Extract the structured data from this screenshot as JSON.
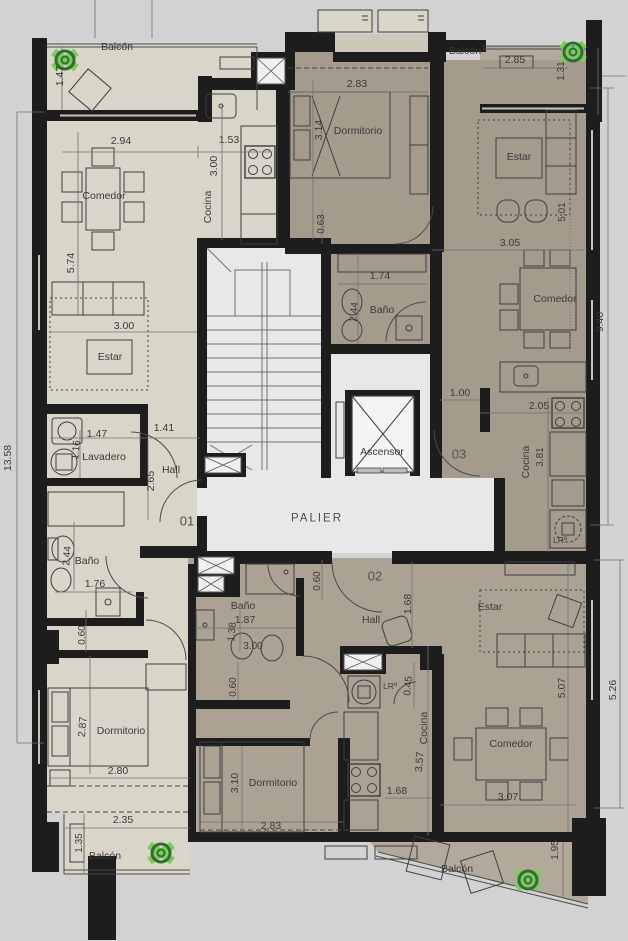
{
  "plan": {
    "type": "architectural-floor-plan",
    "units": [
      "01",
      "02",
      "03"
    ],
    "colors": {
      "background": "#d2d2d2",
      "wall": "#1d1d1d",
      "unit01_floor": "#d9d5c8",
      "unit03_floor": "#a49b8d",
      "unit02_floor": "#aba294",
      "balcony_floor": "#b2a99b",
      "core_floor": "#e8e8e8",
      "elevator_floor": "#f4f4f4",
      "plant_green": "#4ea83c",
      "text": "#3a3a3a"
    },
    "labels": [
      {
        "name": "balcon-01-top",
        "text": "Balcón",
        "x": 117,
        "y": 47,
        "rot": 0,
        "fs": 10.5
      },
      {
        "name": "dim-1-47-v",
        "text": "1.47",
        "x": 60,
        "y": 76,
        "rot": -90,
        "fs": 10.5
      },
      {
        "name": "dim-2-94",
        "text": "2.94",
        "x": 121,
        "y": 141,
        "rot": 0,
        "fs": 10.5
      },
      {
        "name": "dim-1-53",
        "text": "1.53",
        "x": 229,
        "y": 140,
        "rot": 0,
        "fs": 10.5
      },
      {
        "name": "dim-3-00-cocina",
        "text": "3.00",
        "x": 214,
        "y": 166,
        "rot": -90,
        "fs": 10.5
      },
      {
        "name": "cocina-01",
        "text": "Cocina",
        "x": 208,
        "y": 207,
        "rot": -90,
        "fs": 10.5
      },
      {
        "name": "comedor-01",
        "text": "Comedor",
        "x": 104,
        "y": 196,
        "rot": 0,
        "fs": 10.5
      },
      {
        "name": "dim-5-74",
        "text": "5.74",
        "x": 71,
        "y": 263,
        "rot": -90,
        "fs": 10.5
      },
      {
        "name": "dim-3-00-estar",
        "text": "3.00",
        "x": 124,
        "y": 326,
        "rot": 0,
        "fs": 10.5
      },
      {
        "name": "estar-01",
        "text": "Estar",
        "x": 110,
        "y": 357,
        "rot": 0,
        "fs": 10.5
      },
      {
        "name": "dim-13-58",
        "text": "13.58",
        "x": 8,
        "y": 458,
        "rot": -90,
        "fs": 10.5
      },
      {
        "name": "dim-1-47-lav",
        "text": "1.47",
        "x": 97,
        "y": 434,
        "rot": 0,
        "fs": 10.5
      },
      {
        "name": "dim-1-41",
        "text": "1.41",
        "x": 164,
        "y": 428,
        "rot": 0,
        "fs": 10.5
      },
      {
        "name": "lavadero-01",
        "text": "Lavadero",
        "x": 104,
        "y": 457,
        "rot": 0,
        "fs": 10.5
      },
      {
        "name": "dim-1-16",
        "text": "1.16",
        "x": 77,
        "y": 450,
        "rot": -85,
        "fs": 10
      },
      {
        "name": "hall-01",
        "text": "Hall",
        "x": 171,
        "y": 470,
        "rot": 0,
        "fs": 10.5
      },
      {
        "name": "dim-2-65",
        "text": "2.65",
        "x": 151,
        "y": 481,
        "rot": -90,
        "fs": 10.5
      },
      {
        "name": "unit-01",
        "text": "01",
        "x": 187,
        "y": 521,
        "rot": 0,
        "fs": 13,
        "color": "#55504a"
      },
      {
        "name": "bano-01",
        "text": "Baño",
        "x": 87,
        "y": 561,
        "rot": 0,
        "fs": 10.5
      },
      {
        "name": "dim-2-44-b1",
        "text": "2.44",
        "x": 68,
        "y": 556,
        "rot": -85,
        "fs": 10
      },
      {
        "name": "dim-1-76",
        "text": "1.76",
        "x": 95,
        "y": 584,
        "rot": 0,
        "fs": 10.5
      },
      {
        "name": "dim-0-60-b1",
        "text": "0.60",
        "x": 83,
        "y": 635,
        "rot": -90,
        "fs": 10
      },
      {
        "name": "dim-2-87",
        "text": "2.87",
        "x": 83,
        "y": 727,
        "rot": -85,
        "fs": 10.5
      },
      {
        "name": "dormitorio-01",
        "text": "Dormitorio",
        "x": 121,
        "y": 731,
        "rot": 0,
        "fs": 10.5
      },
      {
        "name": "dim-2-80",
        "text": "2.80",
        "x": 118,
        "y": 771,
        "rot": 0,
        "fs": 10.5
      },
      {
        "name": "dim-2-35",
        "text": "2.35",
        "x": 123,
        "y": 820,
        "rot": 0,
        "fs": 10.5
      },
      {
        "name": "dim-1-35",
        "text": "1.35",
        "x": 80,
        "y": 843,
        "rot": -90,
        "fs": 10
      },
      {
        "name": "balcon-01-bottom",
        "text": "Balcón",
        "x": 105,
        "y": 856,
        "rot": 0,
        "fs": 10.5
      },
      {
        "name": "dim-2-83-d3",
        "text": "2.83",
        "x": 357,
        "y": 84,
        "rot": 0,
        "fs": 10.5
      },
      {
        "name": "dim-3-14",
        "text": "3.14",
        "x": 319,
        "y": 130,
        "rot": -90,
        "fs": 10.5
      },
      {
        "name": "dormitorio-03",
        "text": "Dormitorio",
        "x": 358,
        "y": 131,
        "rot": 0,
        "fs": 10.5
      },
      {
        "name": "balcon-03",
        "text": "Balcón",
        "x": 465,
        "y": 51,
        "rot": 0,
        "fs": 10.5
      },
      {
        "name": "dim-2-85",
        "text": "2.85",
        "x": 515,
        "y": 60,
        "rot": 0,
        "fs": 10.5
      },
      {
        "name": "dim-1-31",
        "text": "1.31",
        "x": 562,
        "y": 71,
        "rot": -90,
        "fs": 10
      },
      {
        "name": "estar-03",
        "text": "Estar",
        "x": 519,
        "y": 157,
        "rot": 0,
        "fs": 10.5
      },
      {
        "name": "dim-5-01",
        "text": "5.01",
        "x": 563,
        "y": 212,
        "rot": -90,
        "fs": 10
      },
      {
        "name": "dim-0-63",
        "text": "0.63",
        "x": 322,
        "y": 224,
        "rot": -90,
        "fs": 10
      },
      {
        "name": "dim-1-74",
        "text": "1.74",
        "x": 380,
        "y": 276,
        "rot": 0,
        "fs": 10.5
      },
      {
        "name": "bano-03",
        "text": "Baño",
        "x": 382,
        "y": 310,
        "rot": 0,
        "fs": 10.5
      },
      {
        "name": "dim-2-44-b3",
        "text": "2.44",
        "x": 355,
        "y": 312,
        "rot": -85,
        "fs": 10
      },
      {
        "name": "dim-3-05",
        "text": "3.05",
        "x": 510,
        "y": 243,
        "rot": 0,
        "fs": 10.5
      },
      {
        "name": "comedor-03",
        "text": "Comedor",
        "x": 555,
        "y": 299,
        "rot": 0,
        "fs": 10.5
      },
      {
        "name": "dim-9-40",
        "text": "9.40",
        "x": 600,
        "y": 322,
        "rot": -90,
        "fs": 10.5
      },
      {
        "name": "dim-1-00",
        "text": "1.00",
        "x": 460,
        "y": 393,
        "rot": 0,
        "fs": 10.5
      },
      {
        "name": "dim-2-05",
        "text": "2.05",
        "x": 539,
        "y": 406,
        "rot": 0,
        "fs": 10.5
      },
      {
        "name": "cocina-03",
        "text": "Cocina",
        "x": 526,
        "y": 462,
        "rot": -90,
        "fs": 10.5
      },
      {
        "name": "dim-3-81",
        "text": "3.81",
        "x": 541,
        "y": 457,
        "rot": -90,
        "fs": 10
      },
      {
        "name": "unit-03",
        "text": "03",
        "x": 459,
        "y": 454,
        "rot": 0,
        "fs": 13,
        "color": "#55504a"
      },
      {
        "name": "lavarropas-03",
        "text": "LRº",
        "x": 560,
        "y": 540,
        "rot": 0,
        "fs": 8.5
      },
      {
        "name": "ascensor",
        "text": "Ascensor",
        "x": 382,
        "y": 452,
        "rot": 0,
        "fs": 10.5
      },
      {
        "name": "palier",
        "text": "PALIER",
        "x": 317,
        "y": 519,
        "rot": 0,
        "fs": 11.5,
        "ls": 2,
        "color": "#4c4c4c"
      },
      {
        "name": "dim-0-60-top02",
        "text": "0.60",
        "x": 318,
        "y": 581,
        "rot": -90,
        "fs": 10
      },
      {
        "name": "unit-02",
        "text": "02",
        "x": 375,
        "y": 576,
        "rot": 0,
        "fs": 13,
        "color": "#55504a"
      },
      {
        "name": "bano-02",
        "text": "Baño",
        "x": 243,
        "y": 606,
        "rot": 0,
        "fs": 10.5
      },
      {
        "name": "dim-1-87",
        "text": "1.87",
        "x": 245,
        "y": 620,
        "rot": 0,
        "fs": 10.5
      },
      {
        "name": "hall-02",
        "text": "Hall",
        "x": 371,
        "y": 620,
        "rot": 0,
        "fs": 10.5
      },
      {
        "name": "dim-1-68-v",
        "text": "1.68",
        "x": 408,
        "y": 604,
        "rot": -90,
        "fs": 10.5
      },
      {
        "name": "dim-1-38",
        "text": "1.38",
        "x": 233,
        "y": 632,
        "rot": -85,
        "fs": 10
      },
      {
        "name": "dim-3-00-b2",
        "text": "3.00",
        "x": 253,
        "y": 647,
        "rot": 0,
        "fs": 10
      },
      {
        "name": "lavarropas-02",
        "text": "LRº",
        "x": 390,
        "y": 686,
        "rot": 0,
        "fs": 8.5
      },
      {
        "name": "dim-0-45",
        "text": "0.45",
        "x": 409,
        "y": 686,
        "rot": -85,
        "fs": 10
      },
      {
        "name": "dim-0-60-corr",
        "text": "0.60",
        "x": 234,
        "y": 687,
        "rot": -90,
        "fs": 10
      },
      {
        "name": "estar-02",
        "text": "Estar",
        "x": 490,
        "y": 607,
        "rot": 0,
        "fs": 10.5
      },
      {
        "name": "dim-5-07",
        "text": "5.07",
        "x": 562,
        "y": 688,
        "rot": -90,
        "fs": 10.5
      },
      {
        "name": "dim-5-26",
        "text": "5.26",
        "x": 613,
        "y": 690,
        "rot": -90,
        "fs": 10.5
      },
      {
        "name": "cocina-02",
        "text": "Cocina",
        "x": 424,
        "y": 728,
        "rot": -90,
        "fs": 10.5
      },
      {
        "name": "dim-3-57",
        "text": "3.57",
        "x": 420,
        "y": 762,
        "rot": -85,
        "fs": 10.5
      },
      {
        "name": "dormitorio-02",
        "text": "Dormitorio",
        "x": 273,
        "y": 783,
        "rot": 0,
        "fs": 10.5
      },
      {
        "name": "dim-3-10",
        "text": "3.10",
        "x": 235,
        "y": 783,
        "rot": -90,
        "fs": 10.5
      },
      {
        "name": "comedor-02",
        "text": "Comedor",
        "x": 511,
        "y": 744,
        "rot": 0,
        "fs": 10.5
      },
      {
        "name": "dim-1-68-h",
        "text": "1.68",
        "x": 397,
        "y": 791,
        "rot": 0,
        "fs": 10.5
      },
      {
        "name": "dim-2-83-d2",
        "text": "2.83",
        "x": 271,
        "y": 826,
        "rot": 0,
        "fs": 10.5
      },
      {
        "name": "dim-3-07",
        "text": "3.07",
        "x": 508,
        "y": 797,
        "rot": 0,
        "fs": 10.5
      },
      {
        "name": "balcon-02",
        "text": "Balcón",
        "x": 457,
        "y": 869,
        "rot": 0,
        "fs": 10.5
      },
      {
        "name": "dim-1-95",
        "text": "1.95",
        "x": 556,
        "y": 850,
        "rot": -90,
        "fs": 10
      }
    ]
  }
}
